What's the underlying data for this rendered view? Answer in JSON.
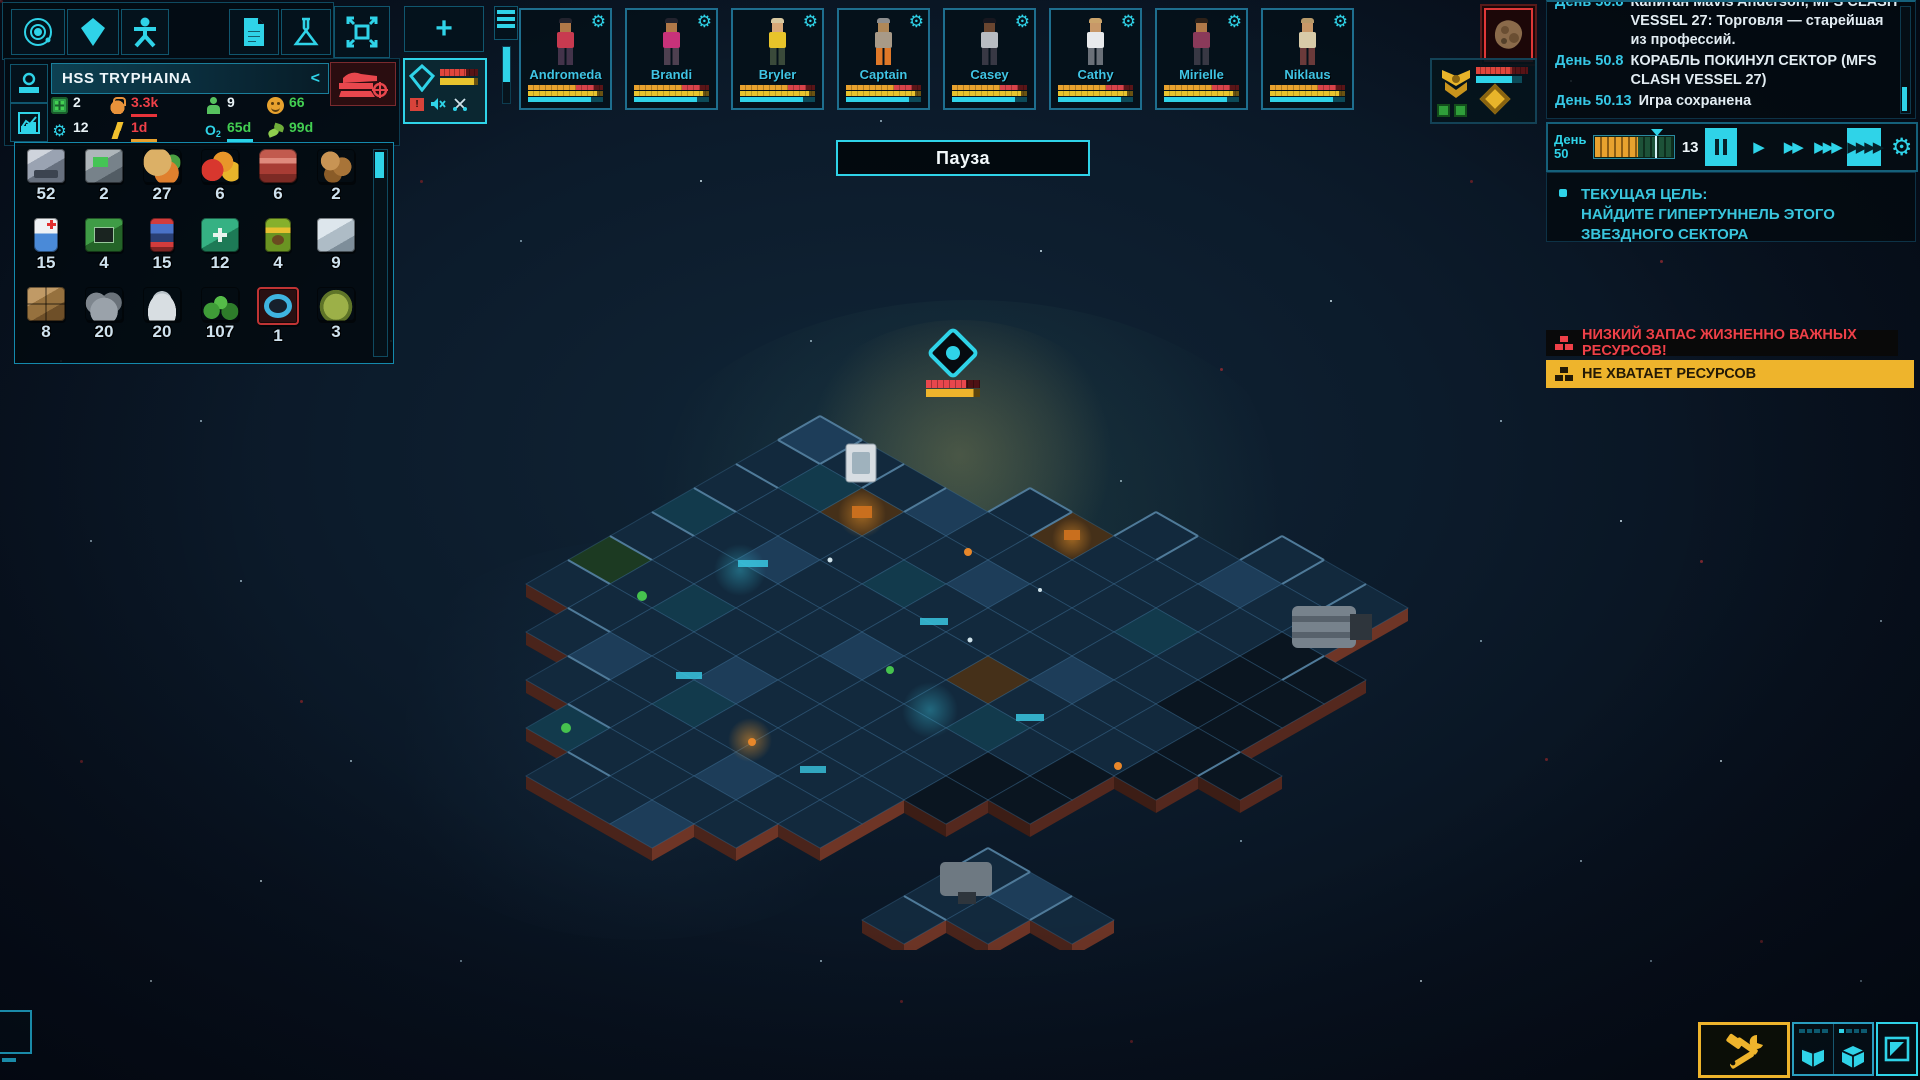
{
  "hud": {
    "pause_banner": "Пауза"
  },
  "toolbar": {
    "icons": [
      "orbit-icon",
      "crystal-icon",
      "person-icon",
      "document-icon",
      "flask-icon",
      "expand-icon",
      "add-icon"
    ]
  },
  "ship_panel": {
    "name": "HSS TRYPHAINA",
    "collapse_label": "<",
    "stats": [
      {
        "icon": "crew-capacity-icon",
        "value": "2",
        "state": "v-white",
        "underline": ""
      },
      {
        "icon": "weight-icon",
        "value": "3.3k",
        "state": "v-red",
        "underline": "#e8333a"
      },
      {
        "icon": "crew-count-icon",
        "value": "9",
        "state": "v-white",
        "underline": ""
      },
      {
        "icon": "mood-icon",
        "value": "66",
        "state": "v-green",
        "underline": ""
      },
      {
        "icon": "power-icon",
        "value": "12",
        "state": "v-white",
        "underline": ""
      },
      {
        "icon": "energy-icon",
        "value": "1d",
        "state": "v-red",
        "underline": "#e8a22e"
      },
      {
        "icon": "oxygen-icon",
        "value": "65d",
        "state": "v-green",
        "underline": "#2ad4e8"
      },
      {
        "icon": "food-icon",
        "value": "99d",
        "state": "v-green",
        "underline": ""
      }
    ]
  },
  "resources": {
    "items": [
      {
        "icon": "hull-blocks",
        "count": "52"
      },
      {
        "icon": "infra-blocks",
        "count": "2"
      },
      {
        "icon": "root-vegetables",
        "count": "27"
      },
      {
        "icon": "fruits",
        "count": "6"
      },
      {
        "icon": "meat",
        "count": "6"
      },
      {
        "icon": "nuts",
        "count": "2"
      },
      {
        "icon": "iv-fluid",
        "count": "15"
      },
      {
        "icon": "tech-blocks",
        "count": "4"
      },
      {
        "icon": "energy-cells",
        "count": "15"
      },
      {
        "icon": "medkits",
        "count": "12"
      },
      {
        "icon": "fertilizer",
        "count": "4"
      },
      {
        "icon": "ice",
        "count": "9"
      },
      {
        "icon": "soft-blocks",
        "count": "8"
      },
      {
        "icon": "ore",
        "count": "20"
      },
      {
        "icon": "powder",
        "count": "20"
      },
      {
        "icon": "plants",
        "count": "107"
      },
      {
        "icon": "hyperium-ring",
        "count": "1"
      },
      {
        "icon": "alien-eggs",
        "count": "3"
      }
    ]
  },
  "crew": {
    "members": [
      {
        "name": "Andromeda",
        "hair": "#23232e",
        "skin": "#b07848",
        "shirt": "#c83a50",
        "pants": "#43334a"
      },
      {
        "name": "Brandi",
        "hair": "#23232e",
        "skin": "#b07848",
        "shirt": "#c8327a",
        "pants": "#4e4050"
      },
      {
        "name": "Bryler",
        "hair": "#d8c8a0",
        "skin": "#d8a878",
        "shirt": "#e8c42a",
        "pants": "#3a4a3a"
      },
      {
        "name": "Captain",
        "hair": "#8d8d8d",
        "skin": "#b08858",
        "shirt": "#a89a88",
        "pants": "#e07828"
      },
      {
        "name": "Casey",
        "hair": "#17171f",
        "skin": "#6a4630",
        "shirt": "#b8bcc2",
        "pants": "#383844"
      },
      {
        "name": "Cathy",
        "hair": "#caa36a",
        "skin": "#c89868",
        "shirt": "#e8eaec",
        "pants": "#6a7078"
      },
      {
        "name": "Mirielle",
        "hair": "#2e2118",
        "skin": "#b07848",
        "shirt": "#8a3a5a",
        "pants": "#383844"
      },
      {
        "name": "Niklaus",
        "hair": "#b89a6a",
        "skin": "#c89868",
        "shirt": "#d8cba8",
        "pants": "#6a3a3a"
      }
    ]
  },
  "fleet": {
    "own_ship_tab_icons": [
      "ship-diamond-icon",
      "alert-icon",
      "muted-speaker-icon",
      "scissors-icon"
    ],
    "other_ship_tab_icons": [
      "faction-badge-icon",
      "diamond-icon",
      "trade-icon",
      "relation-icon"
    ],
    "asteroid_button_icon": "asteroid-icon",
    "own_alert_glyph": "!"
  },
  "time": {
    "day_label": "День",
    "day_value": "50",
    "tick_count": "13"
  },
  "log": {
    "entries": [
      {
        "day": "День 50.8",
        "text": "Капитан Mavis Anderson, MFS CLASH VESSEL 27:  Торговля — старейшая из профессий."
      },
      {
        "day": "День 50.8",
        "text": "КОРАБЛЬ ПОКИНУЛ СЕКТОР (MFS CLASH VESSEL 27)"
      },
      {
        "day": "День 50.13",
        "text": "Игра сохранена"
      }
    ]
  },
  "goal": {
    "title": "ТЕКУЩАЯ ЦЕЛЬ:",
    "text": "НАЙДИТЕ ГИПЕРТУННЕЛЬ ЭТОГО ЗВЕЗДНОГО СЕКТОРА"
  },
  "alerts": [
    {
      "severity": "critical",
      "text": "НИЗКИЙ ЗАПАС ЖИЗНЕННО ВАЖНЫХ РЕСУРСОВ!"
    },
    {
      "severity": "warning",
      "text": "НЕ ХВАТАЕТ РЕСУРСОВ"
    }
  ],
  "colors": {
    "accent_cyan": "#2fd3e8",
    "alert_red": "#e8474d",
    "warning_amber": "#eeb42c",
    "good_green": "#4ec955"
  }
}
